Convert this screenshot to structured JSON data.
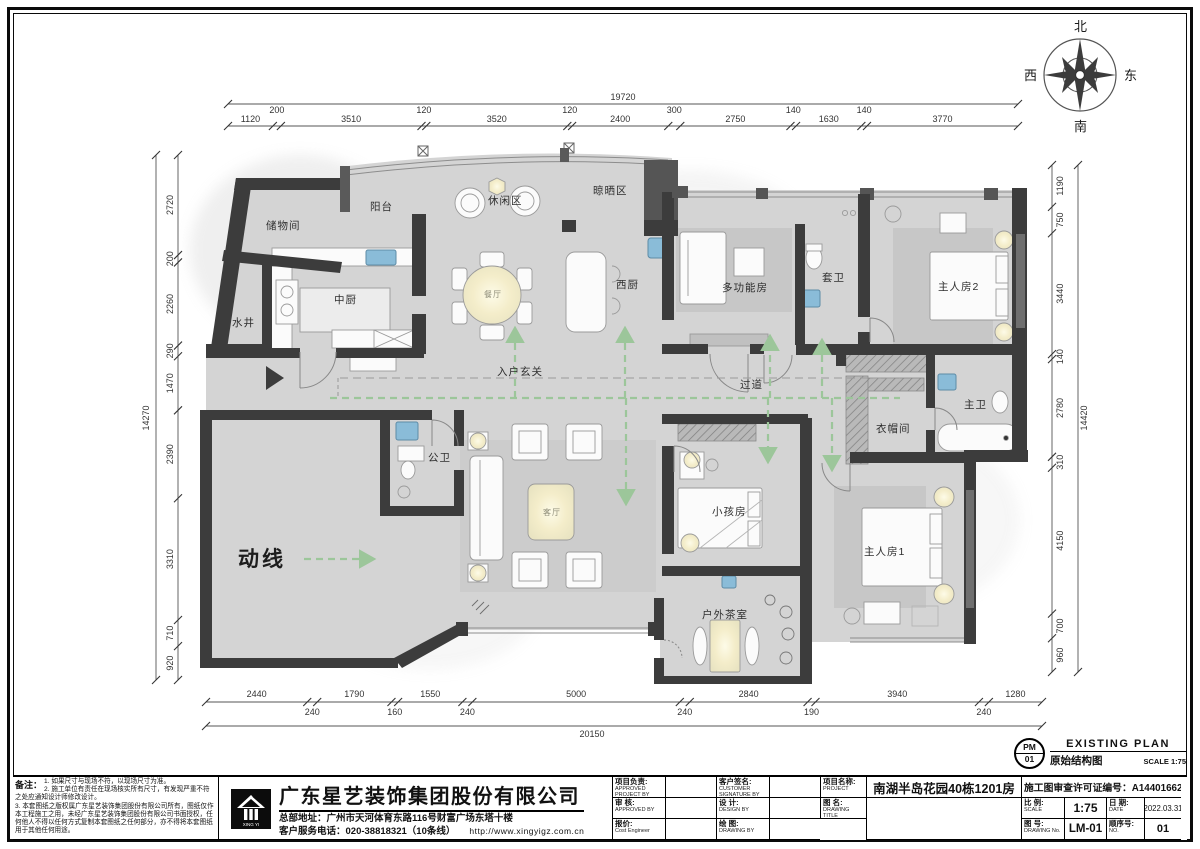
{
  "compass": {
    "n": "北",
    "s": "南",
    "e": "东",
    "w": "西"
  },
  "legend": {
    "circulation": "动线"
  },
  "rooms": {
    "storage": "储物间",
    "well": "水井",
    "balcony": "阳台",
    "leisure": "休闲区",
    "drying": "晾晒区",
    "kitchen_cn": "中厨",
    "kitchen_w": "西厨",
    "dining": "餐厅",
    "multi": "多功能房",
    "ensuite": "套卫",
    "master2": "主人房2",
    "foyer": "入户玄关",
    "corridor": "过道",
    "closet": "衣帽间",
    "master_bath": "主卫",
    "guest_bath": "公卫",
    "living": "客厅",
    "kids": "小孩房",
    "master1": "主人房1",
    "tea": "户外茶室"
  },
  "dims": {
    "top": {
      "overall": "19720",
      "segments": [
        "1120",
        "200",
        "3510",
        "120",
        "3520",
        "120",
        "2400",
        "300",
        "2750",
        "140",
        "1630",
        "140",
        "3770"
      ]
    },
    "bottom": {
      "overall": "20150",
      "segments": [
        "2440",
        "240",
        "1790",
        "160",
        "1550",
        "240",
        "5000",
        "240",
        "2840",
        "190",
        "3940",
        "240",
        "1280"
      ]
    },
    "left": {
      "overall": "14270",
      "segments": [
        "2720",
        "200",
        "2260",
        "290",
        "1470",
        "2390",
        "3310",
        "710",
        "920"
      ]
    },
    "right": {
      "overall": "14420",
      "segments": [
        "1190",
        "750",
        "3440",
        "140",
        "2780",
        "310",
        "4150",
        "700",
        "960"
      ]
    }
  },
  "plan_stamp": {
    "code_top": "PM",
    "code_bottom": "01",
    "title_en": "EXISTING PLAN",
    "title_cn": "原始结构图",
    "scale": "SCALE 1:75"
  },
  "title_block": {
    "notes_label": "备注：",
    "notes": [
      "1. 如果尺寸与现场不符，以现场尺寸为准。",
      "2. 施工单位有责任在现场核实所有尺寸，有发现严重不符之处应通知设计师修改设计。",
      "3. 本套图纸之版权属广东星艺装饰集团股份有限公司所有，图纸仅作本工程施工之用，未经广东星艺装饰集团股份有限公司书面授权，任何他人不得以任何方式复制本套图纸之任何部分，亦不得将本套图纸用于其他任何用途。"
    ],
    "company": {
      "name": "广东星艺装饰集团股份有限公司",
      "address": "总部地址：广州市天河体育东路116号财富广场东塔十楼",
      "phone": "客户服务电话：020-38818321（10条线）",
      "website": "http://www.xingyigz.com.cn",
      "logo_sub": "XING YI"
    },
    "fields": {
      "approved_project": {
        "cn": "项目负责:",
        "en": "APPROVED PROJECT BY"
      },
      "customer_signature": {
        "cn": "客户签名:",
        "en": "CUSTOMER SIGNATURE BY"
      },
      "project": {
        "cn": "项目名称:",
        "en": "PROJECT",
        "value": "南湖半岛花园40栋1201房"
      },
      "permit": {
        "label": "施工图审查许可证编号：",
        "value": "A144016621(甲级)"
      },
      "approved": {
        "cn": "审 核:",
        "en": "APPROVED BY"
      },
      "design": {
        "cn": "设 计:",
        "en": "DESIGN BY"
      },
      "drawing_title": {
        "cn": "图 名:",
        "en": "DRAWING TITLE"
      },
      "scale": {
        "cn": "比 例:",
        "en": "SCALE",
        "value": "1:75"
      },
      "date": {
        "cn": "日 期:",
        "en": "DATE",
        "value": "2022.03.31"
      },
      "cost": {
        "cn": "报价:",
        "en": "Cost Engineer"
      },
      "drawing_by": {
        "cn": "绘 图:",
        "en": "DRAWING BY"
      },
      "drawing_no": {
        "cn": "图 号:",
        "en": "DRAWING No.",
        "value": "LM-01"
      },
      "seq_no": {
        "cn": "顺序号:",
        "en": "NO.",
        "value": "01"
      }
    }
  },
  "colors": {
    "wall": "#3c3c3c",
    "floor": "#d4d4d4",
    "rug": "#c7c7c7",
    "fixture_blue": "#8abcd8",
    "circulation_green": "#9cc69a",
    "glow": "#f4edca"
  }
}
